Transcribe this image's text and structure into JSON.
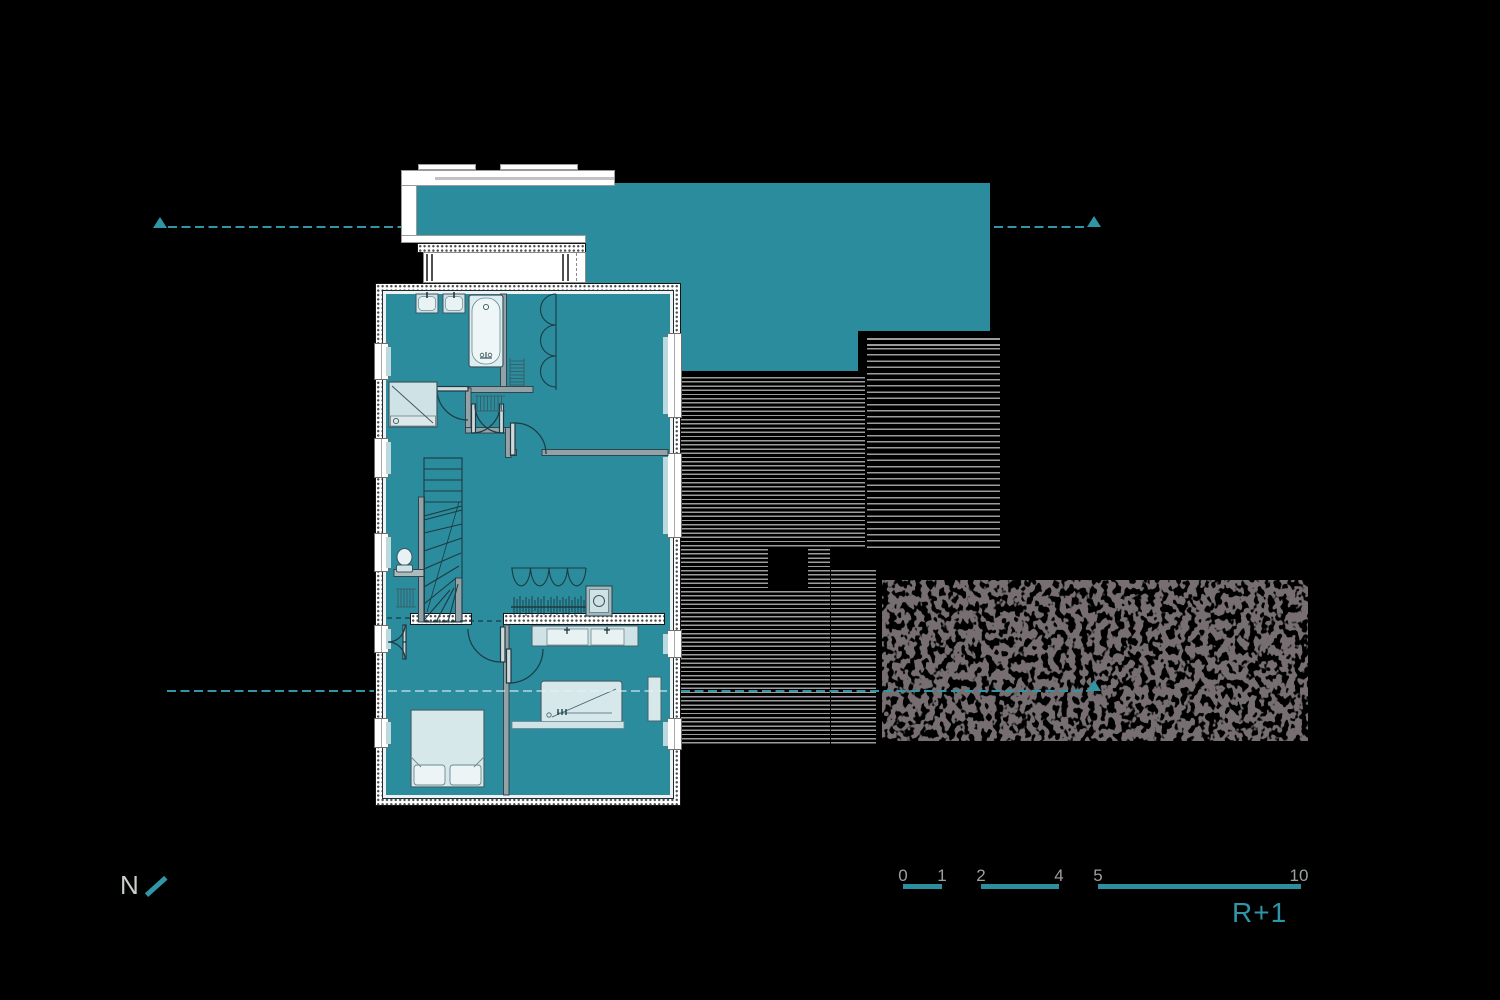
{
  "drawing": {
    "type": "architectural-floor-plan",
    "floor_label": "R+1",
    "north_label": "N"
  },
  "scale_bar": {
    "ticks": [
      "0",
      "1",
      "2",
      "4",
      "5",
      "10"
    ],
    "label": "R+1"
  },
  "colors": {
    "background": "#000000",
    "plan_teal": "#2b8c9e",
    "section_line_teal": "#2e96a6",
    "scale_text_gray": "#9ba0a2",
    "north_text_gray": "#c9cdcd",
    "deck_line_gray": "#9c9c9c",
    "vegetation_gray": "#2e292b",
    "fixture_light": "#d7e8ea",
    "wall_white": "#ffffff"
  },
  "plan_elements": {
    "roof": "flat-roof-teal",
    "balcony": "parapet-balcony",
    "rooms": [
      "bathroom",
      "wc",
      "hall-stairs",
      "bedroom-top-right",
      "bedroom-bottom-left",
      "bedroom-bottom-right"
    ],
    "fixtures": [
      "bathtub",
      "double-washbasin",
      "shower",
      "toilet",
      "staircase",
      "wardrobe",
      "closet",
      "bed",
      "desk",
      "vanity-double-sink",
      "radiators"
    ],
    "exterior": [
      "wood-deck",
      "vegetation-area"
    ]
  }
}
